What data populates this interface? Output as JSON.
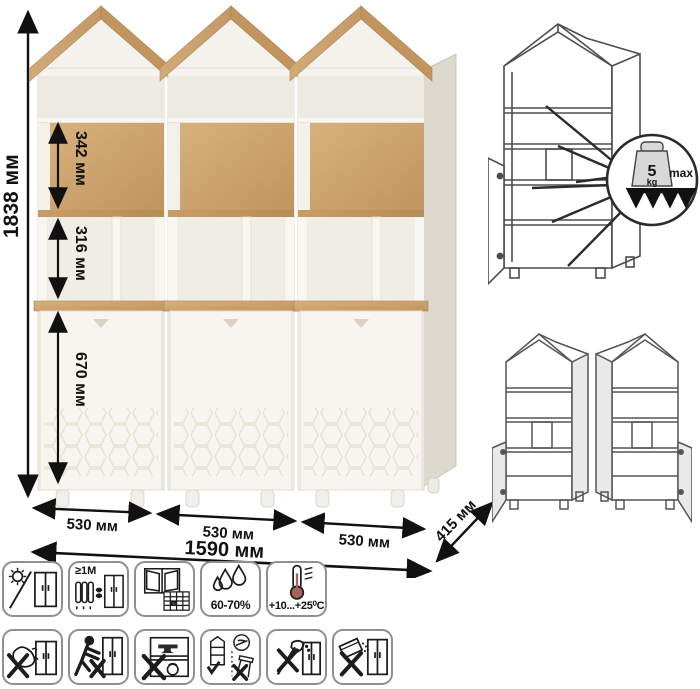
{
  "sheet": {
    "kind": "furniture-dimension-sheet"
  },
  "colors": {
    "wood": "#cda672",
    "wood_dark": "#c0945f",
    "body_white": "#f5f3ed",
    "drawing_line": "#4d4d4d",
    "dimension_line": "#111111"
  },
  "main": {
    "height_total": "1838 мм",
    "section_top": "342 мм",
    "section_middle": "316 мм",
    "section_door": "670 мм",
    "width_left": "530 мм",
    "width_center": "530 мм",
    "width_right": "530 мм",
    "width_total": "1590 мм",
    "depth": "415 мм"
  },
  "load_callout": {
    "value": "5",
    "unit": "kg",
    "limit": "max"
  },
  "care_icons": {
    "row1": [
      {
        "name": "avoid-direct-sunlight"
      },
      {
        "name": "keep-1m-from-heat-sources",
        "label": "≥1M"
      },
      {
        "name": "ventilate-room-regularly"
      },
      {
        "name": "relative-humidity-range",
        "label": "60-70%"
      },
      {
        "name": "temperature-range",
        "label": "+10...+25⁰C"
      }
    ],
    "row2": [
      {
        "name": "no-wet-abrasive-cleaning"
      },
      {
        "name": "do-not-drag-or-push"
      },
      {
        "name": "no-heavy-objects-inside"
      },
      {
        "name": "install-on-level-surface-only"
      },
      {
        "name": "no-sharp-tools"
      },
      {
        "name": "no-spilling-liquids"
      }
    ]
  }
}
